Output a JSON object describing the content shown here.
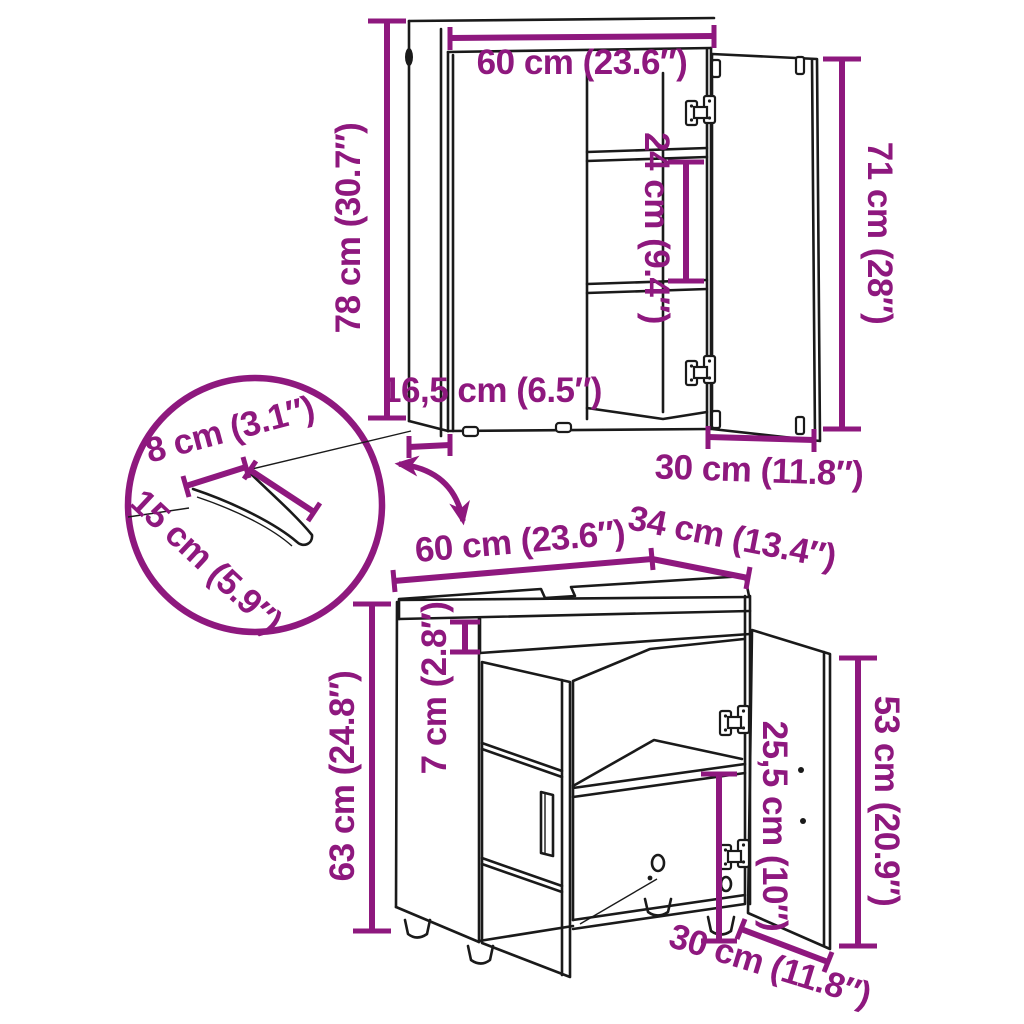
{
  "diagram": {
    "accent_color": "#8e187e",
    "line_color": "#1a1a1a",
    "background_color": "#ffffff",
    "mirror_cabinet": {
      "width": "60 cm (23.6″)",
      "height": "78 cm (30.7″)",
      "shelf_spacing": "24 cm (9.4″)",
      "door_height": "71 cm (28″)",
      "depth": "16,5 cm (6.5″)",
      "door_width": "30 cm (11.8″)"
    },
    "pipe_cutout_detail": {
      "width": "8 cm (3.1″)",
      "depth": "15 cm (5.9″)"
    },
    "sink_cabinet": {
      "width": "60 cm (23.6″)",
      "depth": "34 cm (13.4″)",
      "apron_height": "7 cm (2.8″)",
      "height": "63 cm (24.8″)",
      "inner_height": "25,5 cm (10″)",
      "door_height": "53 cm (20.9″)",
      "door_width": "30 cm (11.8″)"
    }
  }
}
